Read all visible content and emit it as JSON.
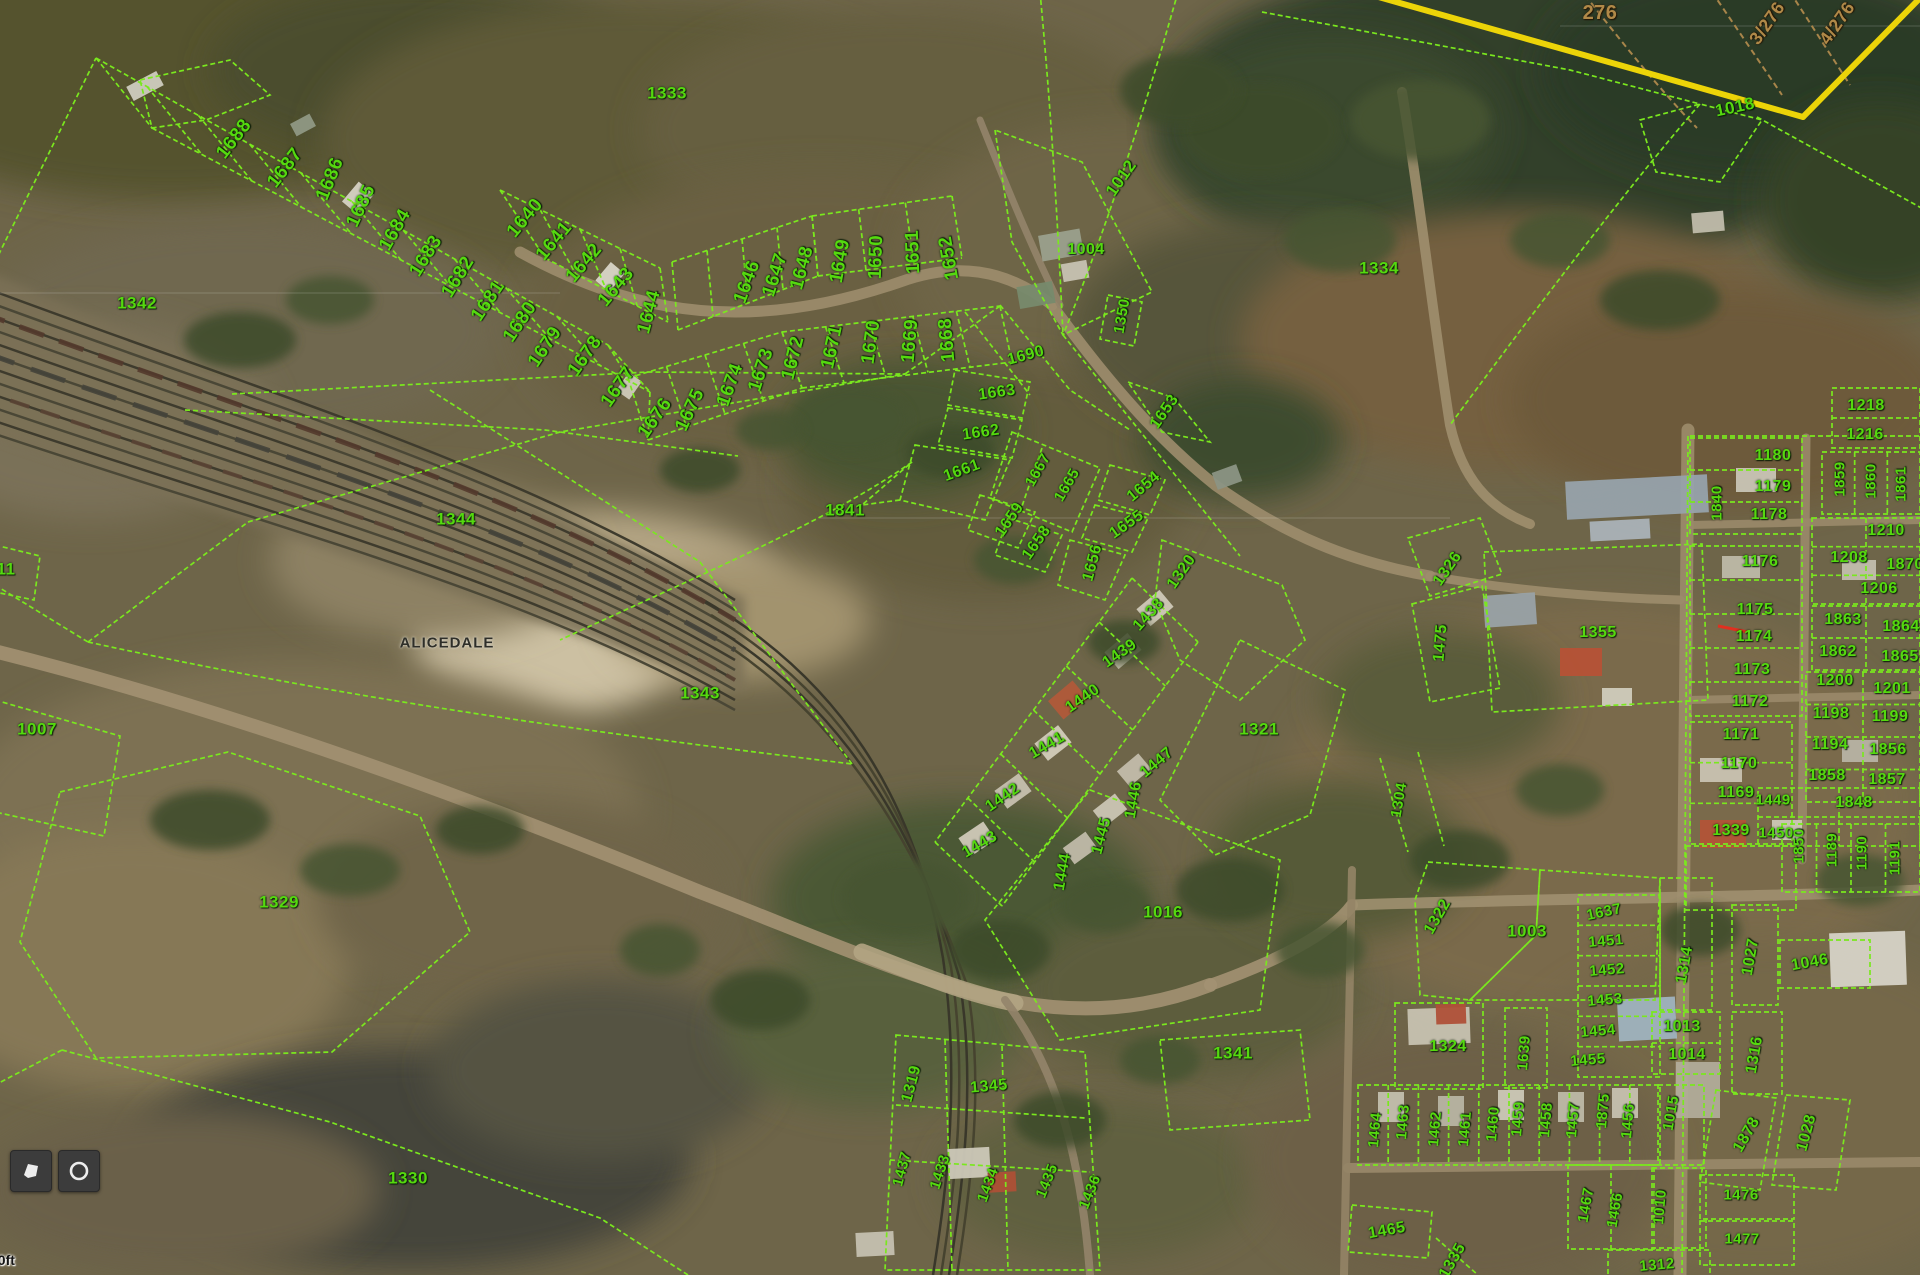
{
  "map": {
    "place_label": "ALICEDALE",
    "scale_text": "00ft",
    "colors": {
      "parcel_line": "#7ae81e",
      "parcel_text": "#55d90f",
      "boundary_tan": "#b08948",
      "road_yellow": "#ecd408",
      "place_text": "#2e2e28"
    },
    "parcel_labels": [
      {
        "t": "1688",
        "x": 234,
        "y": 139,
        "r": -52,
        "fs": 19
      },
      {
        "t": "1687",
        "x": 285,
        "y": 168,
        "r": -52,
        "fs": 19
      },
      {
        "t": "1686",
        "x": 330,
        "y": 179,
        "r": -68,
        "fs": 19
      },
      {
        "t": "1685",
        "x": 361,
        "y": 206,
        "r": -65,
        "fs": 19
      },
      {
        "t": "1684",
        "x": 395,
        "y": 230,
        "r": -60,
        "fs": 19
      },
      {
        "t": "1683",
        "x": 426,
        "y": 256,
        "r": -58,
        "fs": 19
      },
      {
        "t": "1682",
        "x": 458,
        "y": 277,
        "r": -58,
        "fs": 19
      },
      {
        "t": "1681",
        "x": 488,
        "y": 301,
        "r": -56,
        "fs": 19
      },
      {
        "t": "1680",
        "x": 520,
        "y": 322,
        "r": -56,
        "fs": 19
      },
      {
        "t": "1679",
        "x": 545,
        "y": 347,
        "r": -56,
        "fs": 19
      },
      {
        "t": "1678",
        "x": 585,
        "y": 356,
        "r": -55,
        "fs": 19
      },
      {
        "t": "1677",
        "x": 618,
        "y": 387,
        "r": -55,
        "fs": 19
      },
      {
        "t": "1676",
        "x": 655,
        "y": 418,
        "r": -55,
        "fs": 19
      },
      {
        "t": "1675",
        "x": 690,
        "y": 410,
        "r": -65,
        "fs": 19
      },
      {
        "t": "1674",
        "x": 730,
        "y": 385,
        "r": -70,
        "fs": 19
      },
      {
        "t": "1673",
        "x": 761,
        "y": 370,
        "r": -72,
        "fs": 19
      },
      {
        "t": "1672",
        "x": 793,
        "y": 358,
        "r": -76,
        "fs": 19
      },
      {
        "t": "1671",
        "x": 832,
        "y": 347,
        "r": -78,
        "fs": 19
      },
      {
        "t": "1670",
        "x": 871,
        "y": 342,
        "r": -82,
        "fs": 19
      },
      {
        "t": "1669",
        "x": 910,
        "y": 341,
        "r": -85,
        "fs": 19
      },
      {
        "t": "1668",
        "x": 947,
        "y": 340,
        "r": -95,
        "fs": 19
      },
      {
        "t": "1640",
        "x": 525,
        "y": 218,
        "r": -50,
        "fs": 19
      },
      {
        "t": "1641",
        "x": 554,
        "y": 241,
        "r": -50,
        "fs": 19
      },
      {
        "t": "1642",
        "x": 584,
        "y": 263,
        "r": -50,
        "fs": 19
      },
      {
        "t": "1643",
        "x": 616,
        "y": 287,
        "r": -50,
        "fs": 19
      },
      {
        "t": "1644",
        "x": 649,
        "y": 312,
        "r": -75,
        "fs": 19
      },
      {
        "t": "1646",
        "x": 747,
        "y": 282,
        "r": -70,
        "fs": 19
      },
      {
        "t": "1647",
        "x": 775,
        "y": 275,
        "r": -72,
        "fs": 19
      },
      {
        "t": "1648",
        "x": 802,
        "y": 268,
        "r": -75,
        "fs": 19
      },
      {
        "t": "1649",
        "x": 840,
        "y": 261,
        "r": -80,
        "fs": 19
      },
      {
        "t": "1650",
        "x": 876,
        "y": 257,
        "r": -88,
        "fs": 19
      },
      {
        "t": "1651",
        "x": 913,
        "y": 252,
        "r": -92,
        "fs": 19
      },
      {
        "t": "1652",
        "x": 949,
        "y": 258,
        "r": -100,
        "fs": 19
      },
      {
        "t": "1333",
        "x": 667,
        "y": 93,
        "r": 0,
        "fs": 17
      },
      {
        "t": "1342",
        "x": 137,
        "y": 303,
        "r": 0,
        "fs": 17
      },
      {
        "t": "1012",
        "x": 1121,
        "y": 178,
        "r": -55,
        "fs": 17
      },
      {
        "t": "1004",
        "x": 1086,
        "y": 250,
        "r": 0,
        "fs": 16
      },
      {
        "t": "1350",
        "x": 1122,
        "y": 316,
        "r": -80,
        "fs": 15
      },
      {
        "t": "1334",
        "x": 1379,
        "y": 268,
        "r": 0,
        "fs": 17
      },
      {
        "t": "276",
        "x": 1600,
        "y": 13,
        "r": 0,
        "c": "tan",
        "fs": 20
      },
      {
        "t": "3/276",
        "x": 1767,
        "y": 23,
        "r": -55,
        "c": "tan",
        "fs": 18
      },
      {
        "t": "4/276",
        "x": 1837,
        "y": 23,
        "r": -55,
        "c": "tan",
        "fs": 18
      },
      {
        "t": "1018",
        "x": 1735,
        "y": 107,
        "r": -12,
        "fs": 17
      },
      {
        "t": "1690",
        "x": 1026,
        "y": 356,
        "r": -15,
        "fs": 16
      },
      {
        "t": "1663",
        "x": 997,
        "y": 393,
        "r": -8,
        "fs": 16
      },
      {
        "t": "1662",
        "x": 981,
        "y": 433,
        "r": -8,
        "fs": 16
      },
      {
        "t": "1661",
        "x": 962,
        "y": 471,
        "r": -20,
        "fs": 16
      },
      {
        "t": "1667",
        "x": 1038,
        "y": 470,
        "r": -60,
        "fs": 15
      },
      {
        "t": "1665",
        "x": 1067,
        "y": 485,
        "r": -60,
        "fs": 15
      },
      {
        "t": "1653",
        "x": 1165,
        "y": 412,
        "r": -55,
        "fs": 16
      },
      {
        "t": "1654",
        "x": 1144,
        "y": 487,
        "r": -40,
        "fs": 16
      },
      {
        "t": "1655",
        "x": 1127,
        "y": 525,
        "r": -35,
        "fs": 16
      },
      {
        "t": "1656",
        "x": 1093,
        "y": 563,
        "r": -75,
        "fs": 16
      },
      {
        "t": "1658",
        "x": 1037,
        "y": 543,
        "r": -55,
        "fs": 16
      },
      {
        "t": "1659",
        "x": 1010,
        "y": 520,
        "r": -55,
        "fs": 16
      },
      {
        "t": "1841",
        "x": 845,
        "y": 510,
        "r": 0,
        "fs": 17
      },
      {
        "t": "1344",
        "x": 456,
        "y": 519,
        "r": 0,
        "fs": 17
      },
      {
        "t": "1343",
        "x": 700,
        "y": 693,
        "r": 0,
        "fs": 17
      },
      {
        "t": "11",
        "x": 6,
        "y": 569,
        "r": 0,
        "fs": 17
      },
      {
        "t": "1007",
        "x": 37,
        "y": 729,
        "r": 0,
        "fs": 17
      },
      {
        "t": "1329",
        "x": 279,
        "y": 902,
        "r": 0,
        "fs": 17
      },
      {
        "t": "1330",
        "x": 408,
        "y": 1178,
        "r": 0,
        "fs": 17
      },
      {
        "t": "1320",
        "x": 1182,
        "y": 572,
        "r": -55,
        "fs": 16
      },
      {
        "t": "1321",
        "x": 1259,
        "y": 729,
        "r": 0,
        "fs": 17
      },
      {
        "t": "1016",
        "x": 1163,
        "y": 912,
        "r": 0,
        "fs": 17
      },
      {
        "t": "1341",
        "x": 1233,
        "y": 1053,
        "r": 0,
        "fs": 17
      },
      {
        "t": "1438",
        "x": 1149,
        "y": 615,
        "r": -48,
        "fs": 16
      },
      {
        "t": "1439",
        "x": 1120,
        "y": 654,
        "r": -35,
        "fs": 16
      },
      {
        "t": "1440",
        "x": 1083,
        "y": 699,
        "r": -35,
        "fs": 16
      },
      {
        "t": "1441",
        "x": 1047,
        "y": 746,
        "r": -30,
        "fs": 16
      },
      {
        "t": "1442",
        "x": 1003,
        "y": 798,
        "r": -35,
        "fs": 16
      },
      {
        "t": "1443",
        "x": 980,
        "y": 845,
        "r": -30,
        "fs": 16
      },
      {
        "t": "1444",
        "x": 1063,
        "y": 872,
        "r": -80,
        "fs": 16
      },
      {
        "t": "1445",
        "x": 1102,
        "y": 836,
        "r": -75,
        "fs": 16
      },
      {
        "t": "1446",
        "x": 1134,
        "y": 800,
        "r": -80,
        "fs": 16
      },
      {
        "t": "1447",
        "x": 1157,
        "y": 763,
        "r": -40,
        "fs": 16
      },
      {
        "t": "1319",
        "x": 912,
        "y": 1084,
        "r": -75,
        "fs": 16
      },
      {
        "t": "1345",
        "x": 989,
        "y": 1087,
        "r": -5,
        "fs": 16
      },
      {
        "t": "1437",
        "x": 902,
        "y": 1169,
        "r": -75,
        "fs": 15
      },
      {
        "t": "1433",
        "x": 940,
        "y": 1172,
        "r": -72,
        "fs": 15
      },
      {
        "t": "1434",
        "x": 988,
        "y": 1185,
        "r": -70,
        "fs": 15
      },
      {
        "t": "1435",
        "x": 1047,
        "y": 1181,
        "r": -68,
        "fs": 15
      },
      {
        "t": "1436",
        "x": 1090,
        "y": 1192,
        "r": -68,
        "fs": 15
      },
      {
        "t": "1326",
        "x": 1448,
        "y": 569,
        "r": -55,
        "fs": 16
      },
      {
        "t": "1475",
        "x": 1441,
        "y": 643,
        "r": -85,
        "fs": 16
      },
      {
        "t": "1355",
        "x": 1598,
        "y": 633,
        "r": 0,
        "fs": 16
      },
      {
        "t": "1218",
        "x": 1866,
        "y": 406,
        "r": 0,
        "fs": 16
      },
      {
        "t": "1216",
        "x": 1865,
        "y": 435,
        "r": 0,
        "fs": 16
      },
      {
        "t": "1180",
        "x": 1773,
        "y": 456,
        "r": 0,
        "fs": 16
      },
      {
        "t": "1179",
        "x": 1773,
        "y": 487,
        "r": 0,
        "fs": 16
      },
      {
        "t": "1178",
        "x": 1769,
        "y": 515,
        "r": 0,
        "fs": 16
      },
      {
        "t": "1859",
        "x": 1840,
        "y": 479,
        "r": -90,
        "fs": 15
      },
      {
        "t": "1860",
        "x": 1871,
        "y": 481,
        "r": -90,
        "fs": 15
      },
      {
        "t": "1861",
        "x": 1901,
        "y": 484,
        "r": -90,
        "fs": 15
      },
      {
        "t": "1840",
        "x": 1717,
        "y": 503,
        "r": -90,
        "fs": 15
      },
      {
        "t": "1210",
        "x": 1886,
        "y": 531,
        "r": 0,
        "fs": 16
      },
      {
        "t": "1208",
        "x": 1849,
        "y": 558,
        "r": 0,
        "fs": 16
      },
      {
        "t": "1870",
        "x": 1905,
        "y": 565,
        "r": 0,
        "fs": 16
      },
      {
        "t": "1206",
        "x": 1879,
        "y": 589,
        "r": 0,
        "fs": 16
      },
      {
        "t": "1863",
        "x": 1843,
        "y": 620,
        "r": 0,
        "fs": 16
      },
      {
        "t": "1864",
        "x": 1901,
        "y": 627,
        "r": 0,
        "fs": 16
      },
      {
        "t": "1862",
        "x": 1838,
        "y": 652,
        "r": 0,
        "fs": 16
      },
      {
        "t": "1865",
        "x": 1900,
        "y": 657,
        "r": 0,
        "fs": 16
      },
      {
        "t": "1200",
        "x": 1835,
        "y": 681,
        "r": 0,
        "fs": 16
      },
      {
        "t": "1201",
        "x": 1892,
        "y": 689,
        "r": 0,
        "fs": 16
      },
      {
        "t": "1198",
        "x": 1831,
        "y": 714,
        "r": 0,
        "fs": 16
      },
      {
        "t": "1199",
        "x": 1890,
        "y": 717,
        "r": 0,
        "fs": 16
      },
      {
        "t": "1194",
        "x": 1830,
        "y": 745,
        "r": 0,
        "fs": 16
      },
      {
        "t": "1856",
        "x": 1888,
        "y": 750,
        "r": 0,
        "fs": 16
      },
      {
        "t": "1858",
        "x": 1827,
        "y": 776,
        "r": 0,
        "fs": 16
      },
      {
        "t": "1857",
        "x": 1887,
        "y": 780,
        "r": 0,
        "fs": 16
      },
      {
        "t": "1176",
        "x": 1760,
        "y": 562,
        "r": 0,
        "fs": 16
      },
      {
        "t": "1175",
        "x": 1755,
        "y": 610,
        "r": 0,
        "fs": 16
      },
      {
        "t": "1174",
        "x": 1754,
        "y": 637,
        "r": 0,
        "fs": 16
      },
      {
        "t": "1173",
        "x": 1752,
        "y": 670,
        "r": 0,
        "fs": 16
      },
      {
        "t": "1172",
        "x": 1750,
        "y": 702,
        "r": 0,
        "fs": 16
      },
      {
        "t": "1171",
        "x": 1741,
        "y": 735,
        "r": 0,
        "fs": 16
      },
      {
        "t": "1170",
        "x": 1739,
        "y": 764,
        "r": 0,
        "fs": 16
      },
      {
        "t": "1169",
        "x": 1736,
        "y": 793,
        "r": 0,
        "fs": 16
      },
      {
        "t": "1339",
        "x": 1731,
        "y": 831,
        "r": 0,
        "fs": 16
      },
      {
        "t": "1848",
        "x": 1854,
        "y": 803,
        "r": 0,
        "fs": 16
      },
      {
        "t": "1449",
        "x": 1773,
        "y": 800,
        "r": 0,
        "fs": 15
      },
      {
        "t": "1450",
        "x": 1776,
        "y": 833,
        "r": 0,
        "fs": 15
      },
      {
        "t": "1850",
        "x": 1799,
        "y": 846,
        "r": -90,
        "fs": 15
      },
      {
        "t": "1189",
        "x": 1832,
        "y": 850,
        "r": -90,
        "fs": 15
      },
      {
        "t": "1190",
        "x": 1862,
        "y": 853,
        "r": -90,
        "fs": 15
      },
      {
        "t": "1191",
        "x": 1895,
        "y": 858,
        "r": -90,
        "fs": 15
      },
      {
        "t": "1322",
        "x": 1438,
        "y": 917,
        "r": -60,
        "fs": 16
      },
      {
        "t": "1003",
        "x": 1527,
        "y": 931,
        "r": 0,
        "fs": 17
      },
      {
        "t": "1637",
        "x": 1604,
        "y": 912,
        "r": -12,
        "fs": 15
      },
      {
        "t": "1451",
        "x": 1606,
        "y": 941,
        "r": -5,
        "fs": 15
      },
      {
        "t": "1452",
        "x": 1607,
        "y": 970,
        "r": -5,
        "fs": 15
      },
      {
        "t": "1453",
        "x": 1605,
        "y": 1000,
        "r": -5,
        "fs": 15
      },
      {
        "t": "1454",
        "x": 1598,
        "y": 1031,
        "r": -5,
        "fs": 15
      },
      {
        "t": "1455",
        "x": 1588,
        "y": 1060,
        "r": -5,
        "fs": 15
      },
      {
        "t": "1314",
        "x": 1685,
        "y": 965,
        "r": -80,
        "fs": 16
      },
      {
        "t": "1013",
        "x": 1682,
        "y": 1027,
        "r": 0,
        "fs": 16
      },
      {
        "t": "1014",
        "x": 1687,
        "y": 1055,
        "r": 0,
        "fs": 16
      },
      {
        "t": "1027",
        "x": 1751,
        "y": 957,
        "r": -80,
        "fs": 16
      },
      {
        "t": "1046",
        "x": 1810,
        "y": 963,
        "r": -10,
        "fs": 16
      },
      {
        "t": "1316",
        "x": 1755,
        "y": 1055,
        "r": -80,
        "fs": 16
      },
      {
        "t": "1324",
        "x": 1448,
        "y": 1047,
        "r": 0,
        "fs": 16
      },
      {
        "t": "1639",
        "x": 1524,
        "y": 1053,
        "r": -85,
        "fs": 15
      },
      {
        "t": "1304",
        "x": 1399,
        "y": 800,
        "r": -80,
        "fs": 15
      },
      {
        "t": "1464",
        "x": 1375,
        "y": 1130,
        "r": -85,
        "fs": 15
      },
      {
        "t": "1463",
        "x": 1403,
        "y": 1122,
        "r": -85,
        "fs": 15
      },
      {
        "t": "1462",
        "x": 1435,
        "y": 1129,
        "r": -85,
        "fs": 15
      },
      {
        "t": "1461",
        "x": 1465,
        "y": 1129,
        "r": -85,
        "fs": 15
      },
      {
        "t": "1460",
        "x": 1493,
        "y": 1124,
        "r": -85,
        "fs": 15
      },
      {
        "t": "1459",
        "x": 1518,
        "y": 1119,
        "r": -85,
        "fs": 15
      },
      {
        "t": "1458",
        "x": 1546,
        "y": 1120,
        "r": -85,
        "fs": 15
      },
      {
        "t": "1457",
        "x": 1573,
        "y": 1120,
        "r": -85,
        "fs": 15
      },
      {
        "t": "1875",
        "x": 1603,
        "y": 1111,
        "r": -85,
        "fs": 15
      },
      {
        "t": "1456",
        "x": 1628,
        "y": 1121,
        "r": -85,
        "fs": 15
      },
      {
        "t": "1015",
        "x": 1671,
        "y": 1113,
        "r": -80,
        "fs": 15
      },
      {
        "t": "1878",
        "x": 1747,
        "y": 1135,
        "r": -60,
        "fs": 16
      },
      {
        "t": "1028",
        "x": 1807,
        "y": 1133,
        "r": -75,
        "fs": 16
      },
      {
        "t": "1465",
        "x": 1387,
        "y": 1231,
        "r": -10,
        "fs": 16
      },
      {
        "t": "1335",
        "x": 1453,
        "y": 1261,
        "r": -60,
        "fs": 16
      },
      {
        "t": "1467",
        "x": 1586,
        "y": 1205,
        "r": -80,
        "fs": 15
      },
      {
        "t": "1466",
        "x": 1615,
        "y": 1210,
        "r": -80,
        "fs": 15
      },
      {
        "t": "1010",
        "x": 1660,
        "y": 1207,
        "r": -85,
        "fs": 15
      },
      {
        "t": "1476",
        "x": 1741,
        "y": 1195,
        "r": 0,
        "fs": 15
      },
      {
        "t": "1477",
        "x": 1742,
        "y": 1239,
        "r": 0,
        "fs": 15
      },
      {
        "t": "1312",
        "x": 1657,
        "y": 1265,
        "r": -5,
        "fs": 15
      }
    ]
  },
  "controls": {
    "buttons": [
      {
        "label": "polygon tool",
        "icon": "polygon-icon"
      },
      {
        "label": "locate",
        "icon": "locate-icon"
      }
    ]
  }
}
